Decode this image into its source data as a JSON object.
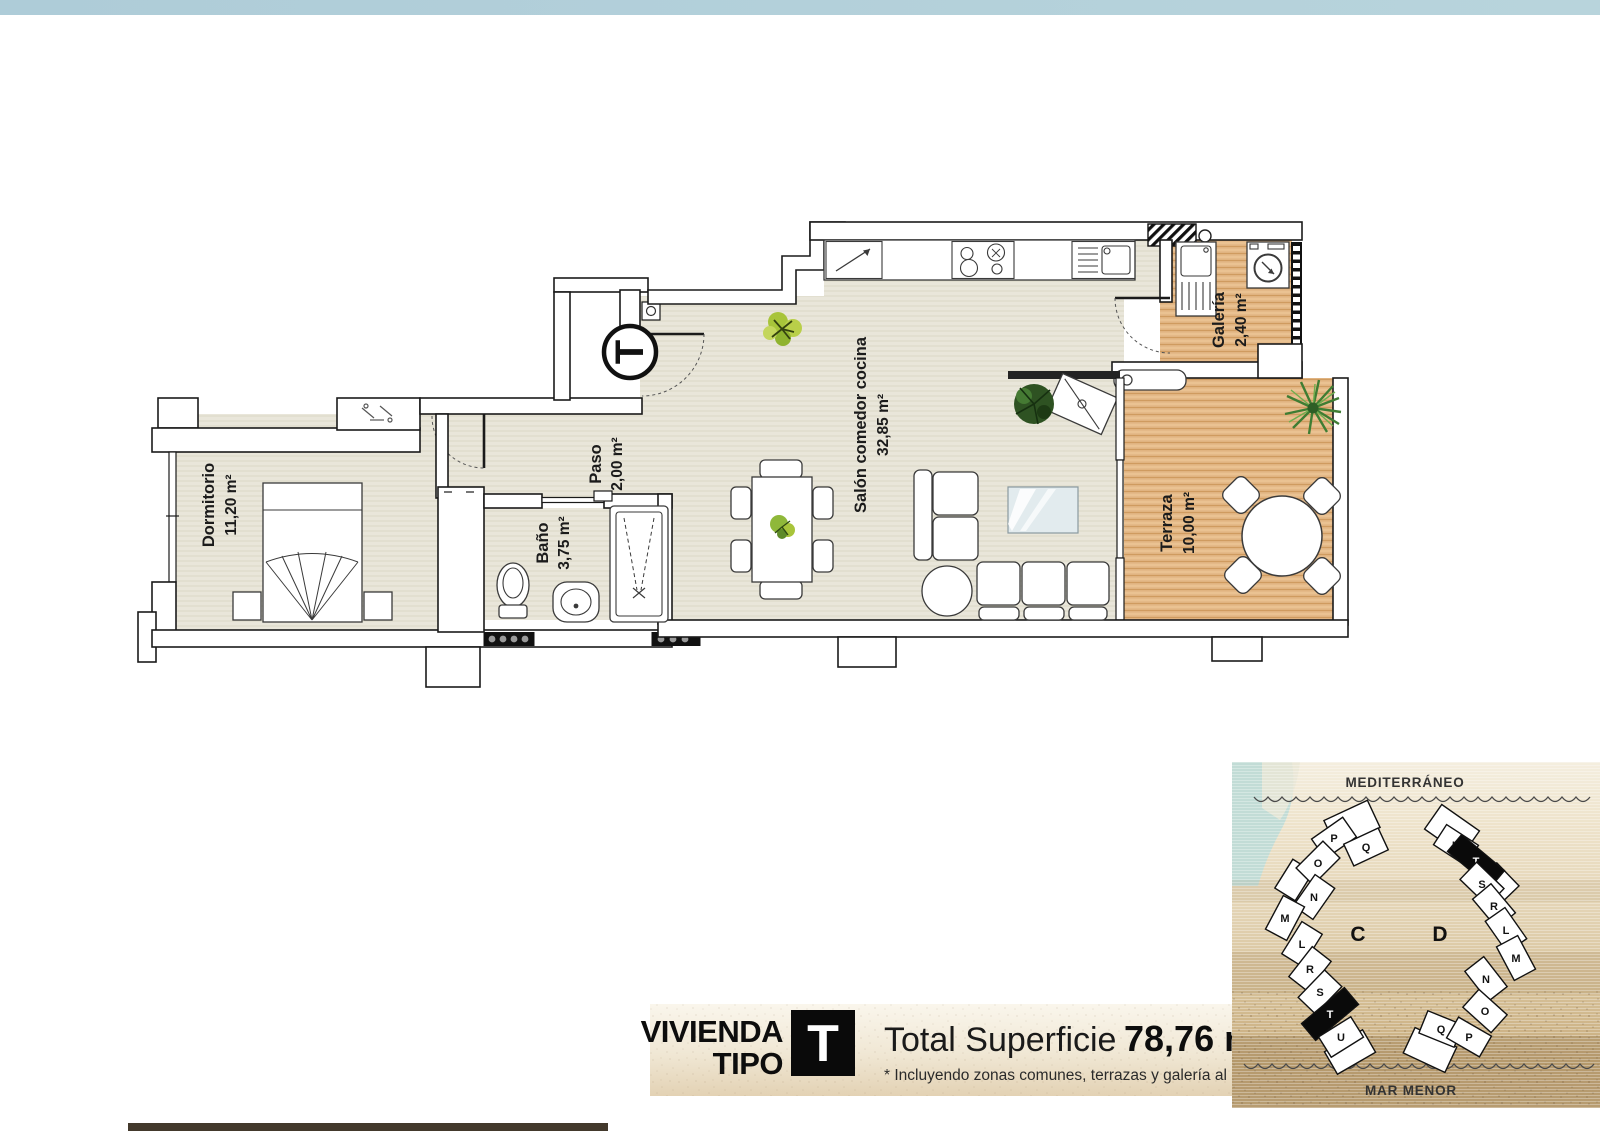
{
  "page": {
    "top_bar_color": "#b3d0da",
    "background": "#ffffff"
  },
  "floor_plan": {
    "entrance_marker": "T",
    "rooms": [
      {
        "id": "dormitorio",
        "name": "Dormitorio",
        "area": "11,20 m²"
      },
      {
        "id": "paso",
        "name": "Paso",
        "area": "2,00 m²"
      },
      {
        "id": "bano",
        "name": "Baño",
        "area": "3,75 m²"
      },
      {
        "id": "salon",
        "name": "Salón comedor cocina",
        "area": "32,85 m²"
      },
      {
        "id": "galeria",
        "name": "Galería",
        "area": "2,40 m²"
      },
      {
        "id": "terraza",
        "name": "Terraza",
        "area": "10,00 m²"
      }
    ]
  },
  "banner": {
    "vivienda_line1": "VIVIENDA",
    "vivienda_line2": "TIPO",
    "type_letter": "T",
    "total_label": "Total Superficie",
    "total_value": "78,76 m²",
    "footnote": "* Incluyendo zonas comunes, terrazas y galería al 100%."
  },
  "site_map": {
    "sea_label": "MEDITERRÁNEO",
    "lagoon_label": "MAR MENOR",
    "building_c": {
      "label": "C",
      "units": [
        {
          "label": "P",
          "highlighted": false
        },
        {
          "label": "Q",
          "highlighted": false
        },
        {
          "label": "O",
          "highlighted": false
        },
        {
          "label": "N",
          "highlighted": false
        },
        {
          "label": "M",
          "highlighted": false
        },
        {
          "label": "L",
          "highlighted": false
        },
        {
          "label": "R",
          "highlighted": false
        },
        {
          "label": "S",
          "highlighted": false
        },
        {
          "label": "T",
          "highlighted": true
        },
        {
          "label": "U",
          "highlighted": false
        }
      ]
    },
    "building_d": {
      "label": "D",
      "units": [
        {
          "label": "U",
          "highlighted": false
        },
        {
          "label": "T",
          "highlighted": true
        },
        {
          "label": "S",
          "highlighted": false
        },
        {
          "label": "R",
          "highlighted": false
        },
        {
          "label": "L",
          "highlighted": false
        },
        {
          "label": "M",
          "highlighted": false
        },
        {
          "label": "N",
          "highlighted": false
        },
        {
          "label": "O",
          "highlighted": false
        },
        {
          "label": "Q",
          "highlighted": false
        },
        {
          "label": "P",
          "highlighted": false
        }
      ]
    }
  }
}
